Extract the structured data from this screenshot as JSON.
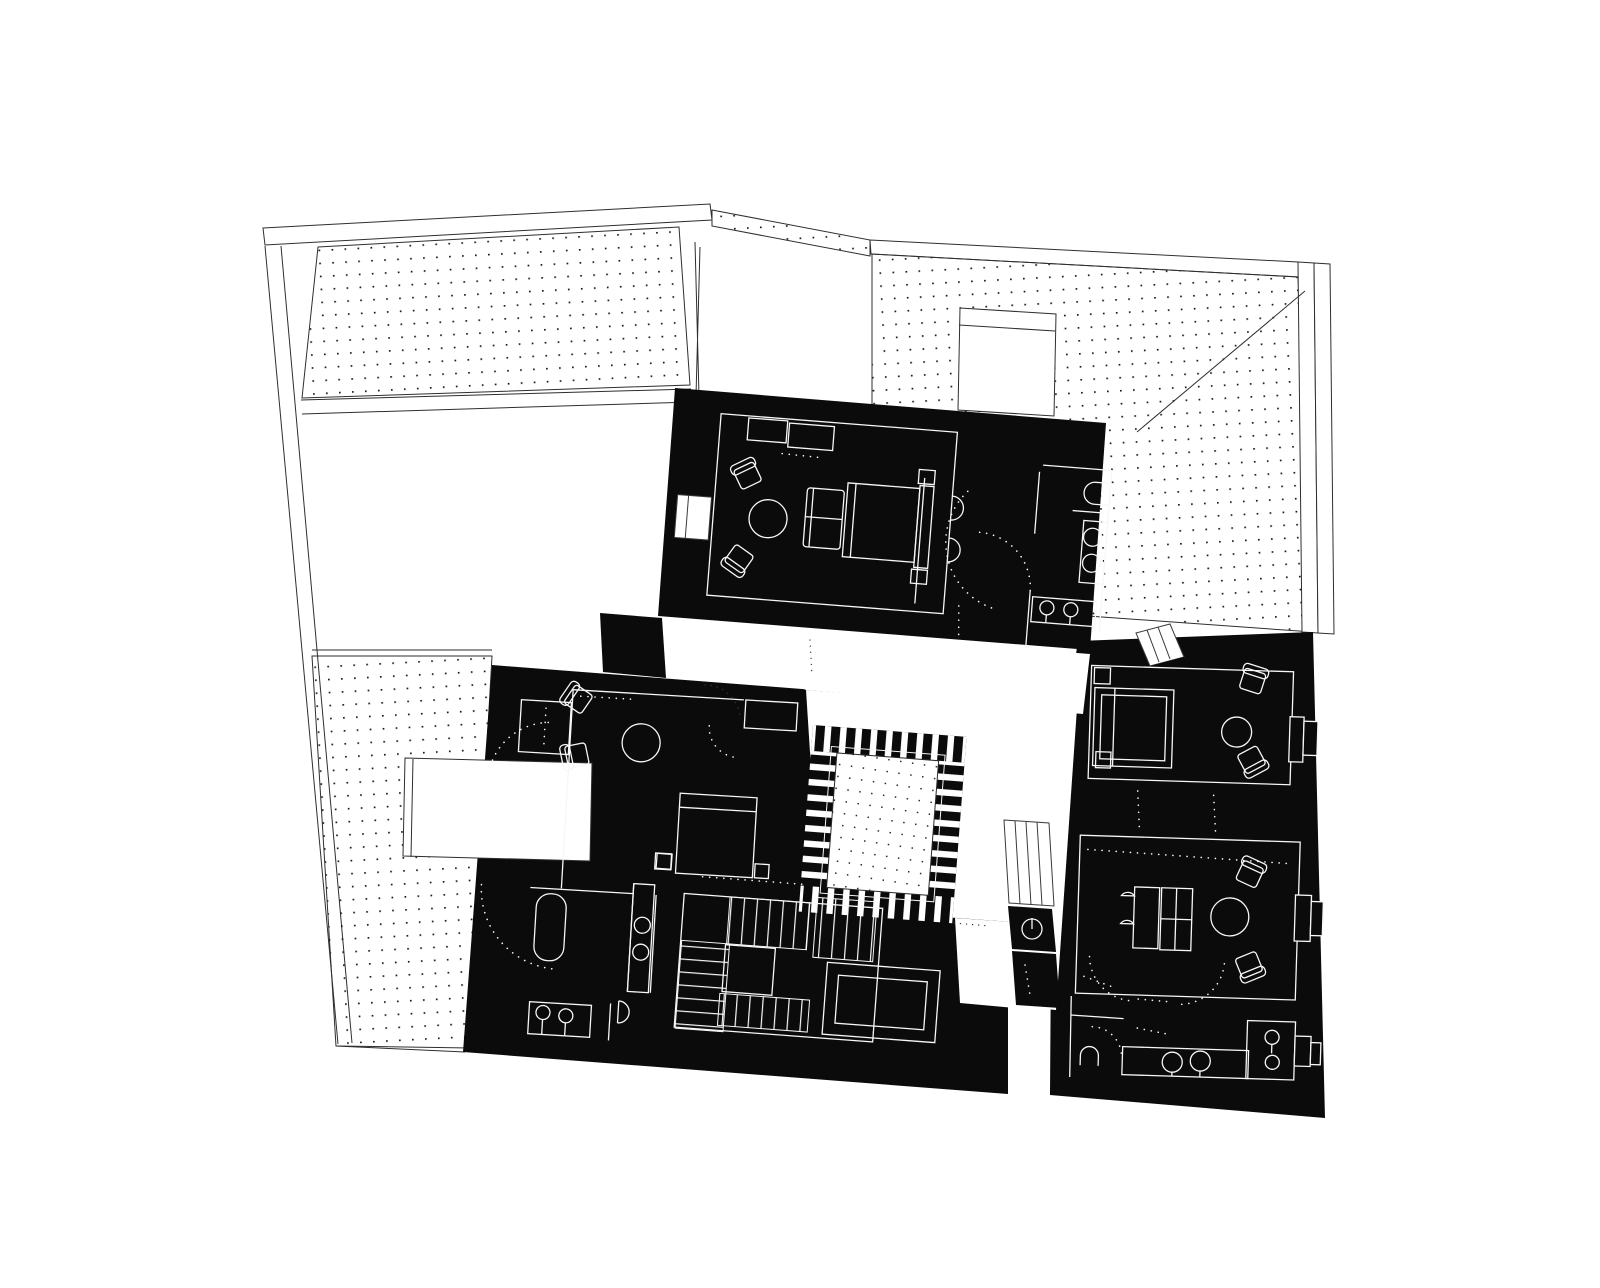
{
  "figure": {
    "width": 1600,
    "height": 1288,
    "background": "#ffffff",
    "description": "Black-and-white architectural roof/floor plan: white dotted roof planes surround a black upper-floor plan with white furniture line-work and a central striped courtyard skylight"
  },
  "colors": {
    "ink": "#0b0b0b",
    "paper": "#ffffff",
    "roof_line": "#2e2e2e",
    "wall": "#f7f7f7",
    "hatch_dot": "#1c1c1c"
  },
  "regions": {
    "roof_top_left": "dotted roof plane, top left",
    "roof_top_right": "dotted roof plane with hip line and chimney, top right",
    "roof_left": "dotted roof plane with dormer notch, left",
    "skylight_void": "white void between roof planes",
    "hall": "white central hall around courtyard",
    "courtyard": "central courtyard skylight with striped border and dotted floor",
    "master_suite": "top bedroom with seating, bed and en-suite bathroom",
    "left_bedroom": "left bedroom with seating, bed, closet and bathroom",
    "bathroom": "bathroom with tub, twin sinks, vanity and wc",
    "stair_core": "square winding stair with central landing and skylight",
    "gap_walkway": "narrow light well with small stair and wc",
    "bridge": "small stepped bridge between wings",
    "right_upper_bedroom": "right wing bedroom with canopy bed, chairs and table",
    "right_lower_lounge": "right wing lounge with sofas, chairs and table",
    "kitchenette": "right wing kitchenette and wc with twin sinks"
  },
  "furniture": {
    "armchairs": 8,
    "round_tables": 4,
    "beds": 3,
    "sofas": 2,
    "bathtubs": 1,
    "sinks": 10,
    "toilets": 5
  }
}
